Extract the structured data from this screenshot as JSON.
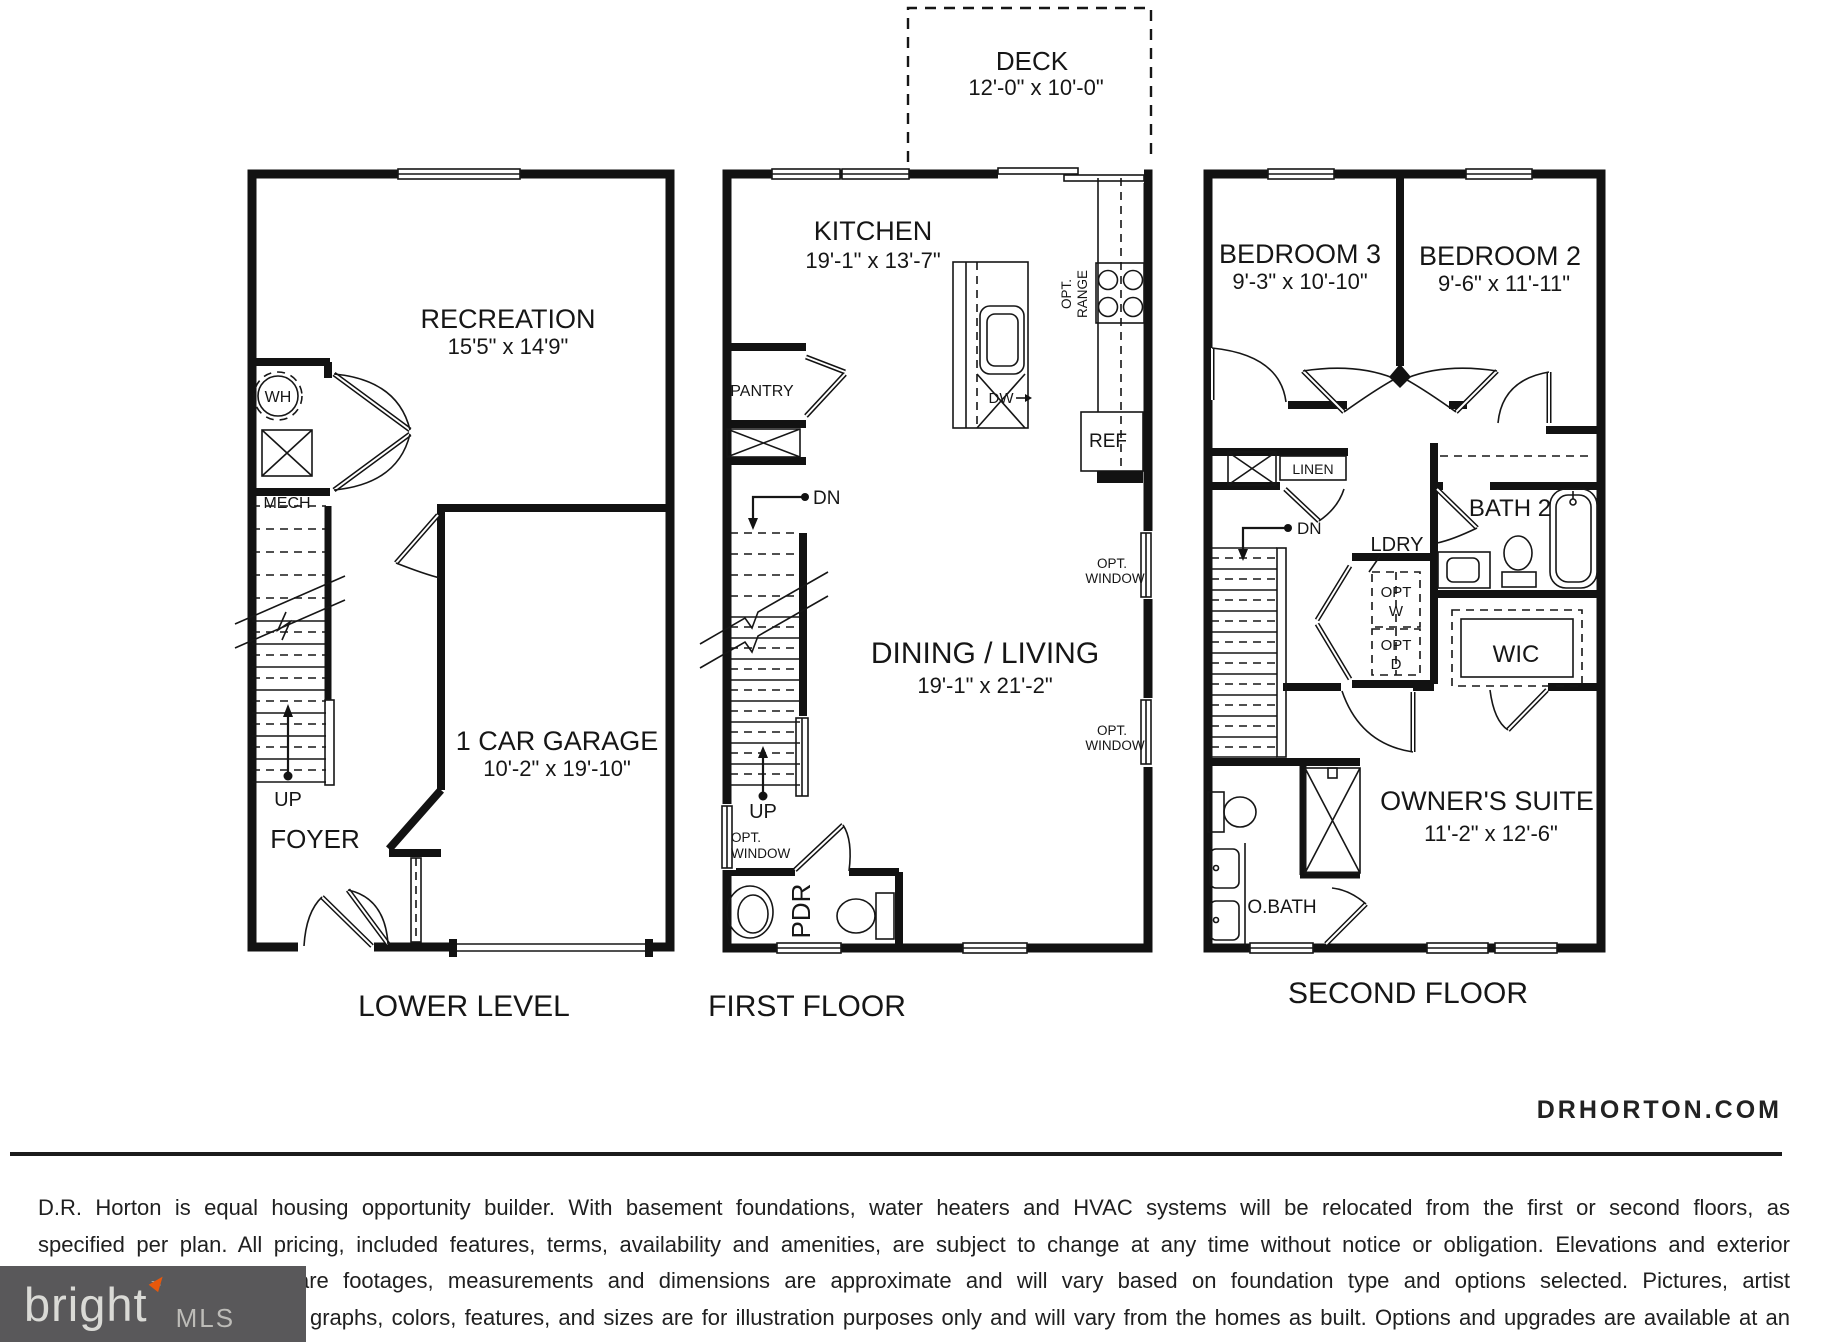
{
  "deck": {
    "label": "DECK",
    "dims": "12'-0\" x 10'-0\""
  },
  "lower_level": {
    "caption": "LOWER LEVEL",
    "recreation_label": "RECREATION",
    "recreation_dims": "15'5\" x 14'9\"",
    "wh_label": "WH",
    "mech_label": "MECH",
    "up_label": "UP",
    "foyer_label": "FOYER",
    "garage_label": "1 CAR GARAGE",
    "garage_dims": "10'-2\" x 19'-10\""
  },
  "first_floor": {
    "caption": "FIRST FLOOR",
    "kitchen_label": "KITCHEN",
    "kitchen_dims": "19'-1\" x 13'-7\"",
    "pantry_label": "PANTRY",
    "dn_label": "DN",
    "up_label": "UP",
    "dw_label": "DW",
    "ref_label": "REF",
    "opt_label": "OPT.",
    "range_label": "RANGE",
    "window_label": "WINDOW",
    "dining_label": "DINING / LIVING",
    "dining_dims": "19'-1\" x 21'-2\"",
    "pdr_label": "PDR"
  },
  "second_floor": {
    "caption": "SECOND FLOOR",
    "bedroom3_label": "BEDROOM 3",
    "bedroom3_dims": "9'-3\" x 10'-10\"",
    "bedroom2_label": "BEDROOM 2",
    "bedroom2_dims": "9'-6\" x 11'-11\"",
    "linen_label": "LINEN",
    "dn_label": "DN",
    "ldry_label": "LDRY",
    "opt_label": "OPT",
    "w_label": "W",
    "d_label": "D",
    "bath2_label": "BATH 2",
    "wic_label": "WIC",
    "owners_label": "OWNER'S SUITE",
    "owners_dims": "11'-2\" x 12'-6\"",
    "obath_label": "O.BATH"
  },
  "footer": {
    "website": "DRHORTON.COM",
    "disclaimer": [
      "D.R. Horton is equal housing opportunity builder. With basement foundations, water heaters and HVAC systems will be relocated from the first or second floors, as",
      "specified per plan. All pricing, included features, terms, availability and amenities, are subject to change at any time without notice or obligation. Elevations and exterior",
      "materials may vary. Square footages, measurements and dimensions are approximate and will vary based on foundation type and options selected. Pictures, artist",
      "graphs, colors, features, and sizes are for illustration purposes only and will vary from the homes as built. Options and upgrades are available at an",
      "d are subject to availability and construction cut-off dates"
    ],
    "plan_code": "DT03-24/40-2343-021919",
    "logo": {
      "name": "bright",
      "tm": "™",
      "suffix": "MLS"
    }
  }
}
